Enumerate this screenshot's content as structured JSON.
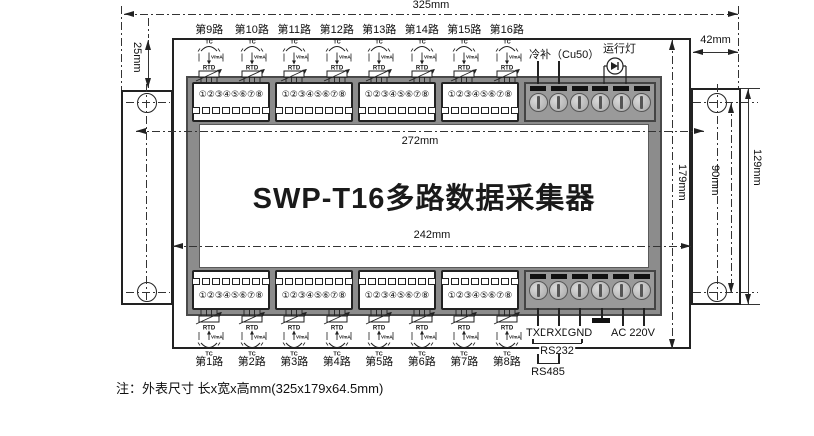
{
  "device": {
    "title": "SWP-T16多路数据采集器",
    "note": "注：外表尺寸 长x宽x高mm(325x179x64.5mm)"
  },
  "dims": {
    "overall_width": "325mm",
    "front_width": "272mm",
    "window_width": "242mm",
    "case_height": "179mm",
    "hole_spacing": "90mm",
    "bracket_height": "129mm",
    "top_inset": "25mm",
    "bracket_width": "42mm"
  },
  "channels": {
    "top": [
      "第9路",
      "第10路",
      "第11路",
      "第12路",
      "第13路",
      "第14路",
      "第15路",
      "第16路"
    ],
    "bottom": [
      "第1路",
      "第2路",
      "第3路",
      "第4路",
      "第5路",
      "第6路",
      "第7路",
      "第8路"
    ],
    "sensor_labels": {
      "tc": "TC",
      "vma": "V/mA",
      "rtd": "RTD"
    }
  },
  "terminals": {
    "numbers": "①②③④⑤⑥⑦⑧",
    "groups_per_strip": 4,
    "screws_per_block": 6
  },
  "top_right": {
    "cold_junction": "冷补（Cu50）",
    "run_lamp": "运行灯"
  },
  "comm": {
    "txd": "TXD",
    "rxd": "RXD",
    "gnd": "GND",
    "ac": "AC 220V",
    "rs232": "RS232",
    "rs485": "RS485"
  },
  "colors": {
    "line": "#222222",
    "panel_frame": "#8c8c8c",
    "terminal_block": "#9a9a9a",
    "screw_head": "#c8c8c8",
    "bar_black": "#111111",
    "background": "#ffffff"
  }
}
